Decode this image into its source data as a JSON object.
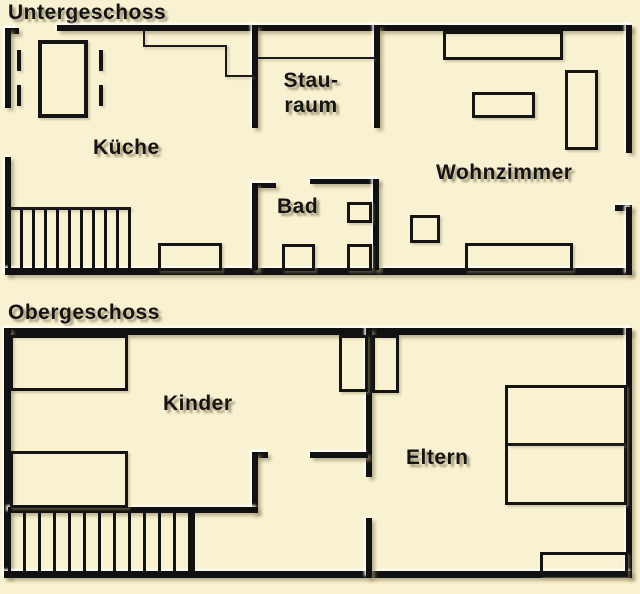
{
  "diagram": {
    "type": "floor-plan",
    "description_language": "German"
  },
  "colors": {
    "background": "#f8f2d2",
    "wall": "#111111",
    "text": "#141414"
  },
  "floors": [
    {
      "title": "Untergeschoss",
      "rooms": {
        "kueche": "Küche",
        "stauraum_line1": "Stau-",
        "stauraum_line2": "raum",
        "bad": "Bad",
        "wohnzimmer": "Wohnzimmer"
      }
    },
    {
      "title": "Obergeschoss",
      "rooms": {
        "kinder": "Kinder",
        "eltern": "Eltern"
      }
    }
  ]
}
